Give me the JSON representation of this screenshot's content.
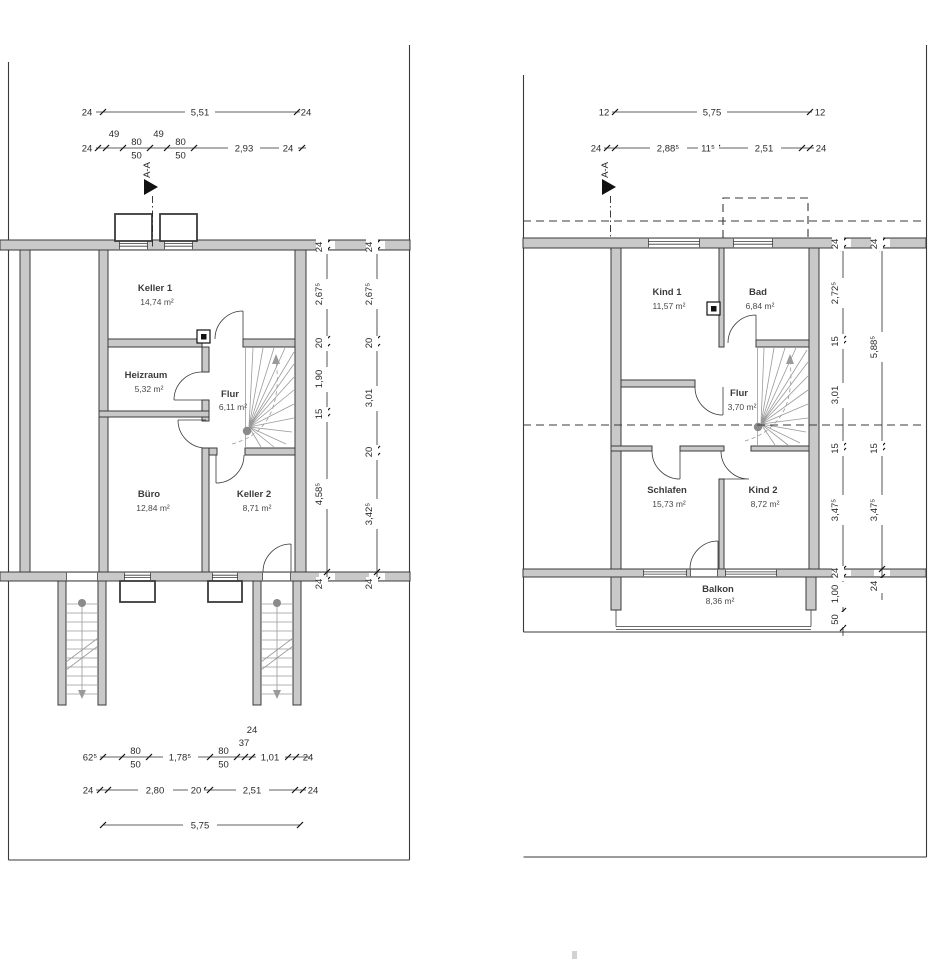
{
  "left_plan": {
    "section": "A-A",
    "rooms": [
      {
        "name": "Keller 1",
        "area": "14,74 m²"
      },
      {
        "name": "Heizraum",
        "area": "5,32 m²"
      },
      {
        "name": "Flur",
        "area": "6,11 m²"
      },
      {
        "name": "Büro",
        "area": "12,84 m²"
      },
      {
        "name": "Keller 2",
        "area": "8,71 m²"
      }
    ],
    "dim_top1": [
      "24",
      "5,51",
      "24"
    ],
    "dim_top2": [
      "24",
      "49",
      "80",
      "50",
      "49",
      "80",
      "50",
      "2,93",
      "24"
    ],
    "dim_right_inner": [
      "24",
      "2,67⁵",
      "20",
      "1,90",
      "15",
      "4,58⁵",
      "24"
    ],
    "dim_right_outer": [
      "24",
      "2,67⁵",
      "20",
      "3,01",
      "20",
      "3,42⁵",
      "24"
    ],
    "dim_bottom1": [
      "62⁵",
      "80",
      "50",
      "1,78⁵",
      "80",
      "50",
      "24",
      "37",
      "1,01",
      "24"
    ],
    "dim_bottom2": [
      "24",
      "2,80",
      "20",
      "2,51",
      "24"
    ],
    "dim_bottom3": [
      "5,75"
    ]
  },
  "right_plan": {
    "section": "A-A",
    "rooms": [
      {
        "name": "Kind 1",
        "area": "11,57 m²"
      },
      {
        "name": "Bad",
        "area": "6,84 m²"
      },
      {
        "name": "Flur",
        "area": "3,70 m²"
      },
      {
        "name": "Schlafen",
        "area": "15,73 m²"
      },
      {
        "name": "Kind 2",
        "area": "8,72 m²"
      },
      {
        "name": "Balkon",
        "area": "8,36 m²"
      }
    ],
    "dim_top1": [
      "12",
      "5,75",
      "12"
    ],
    "dim_top2": [
      "24",
      "2,88⁵",
      "11⁵",
      "2,51",
      "24"
    ],
    "dim_right_inner": [
      "24",
      "2,72⁵",
      "15",
      "3,01",
      "15",
      "3,47⁵",
      "24",
      "1,00",
      "50"
    ],
    "dim_right_outer": [
      "24",
      "5,88⁵",
      "15",
      "3,47⁵",
      "24"
    ]
  },
  "colors": {
    "wall_fill": "#c9c9c9",
    "line": "#3a3a3a",
    "stair": "#9a9a9a",
    "text": "#3c3c3c"
  }
}
